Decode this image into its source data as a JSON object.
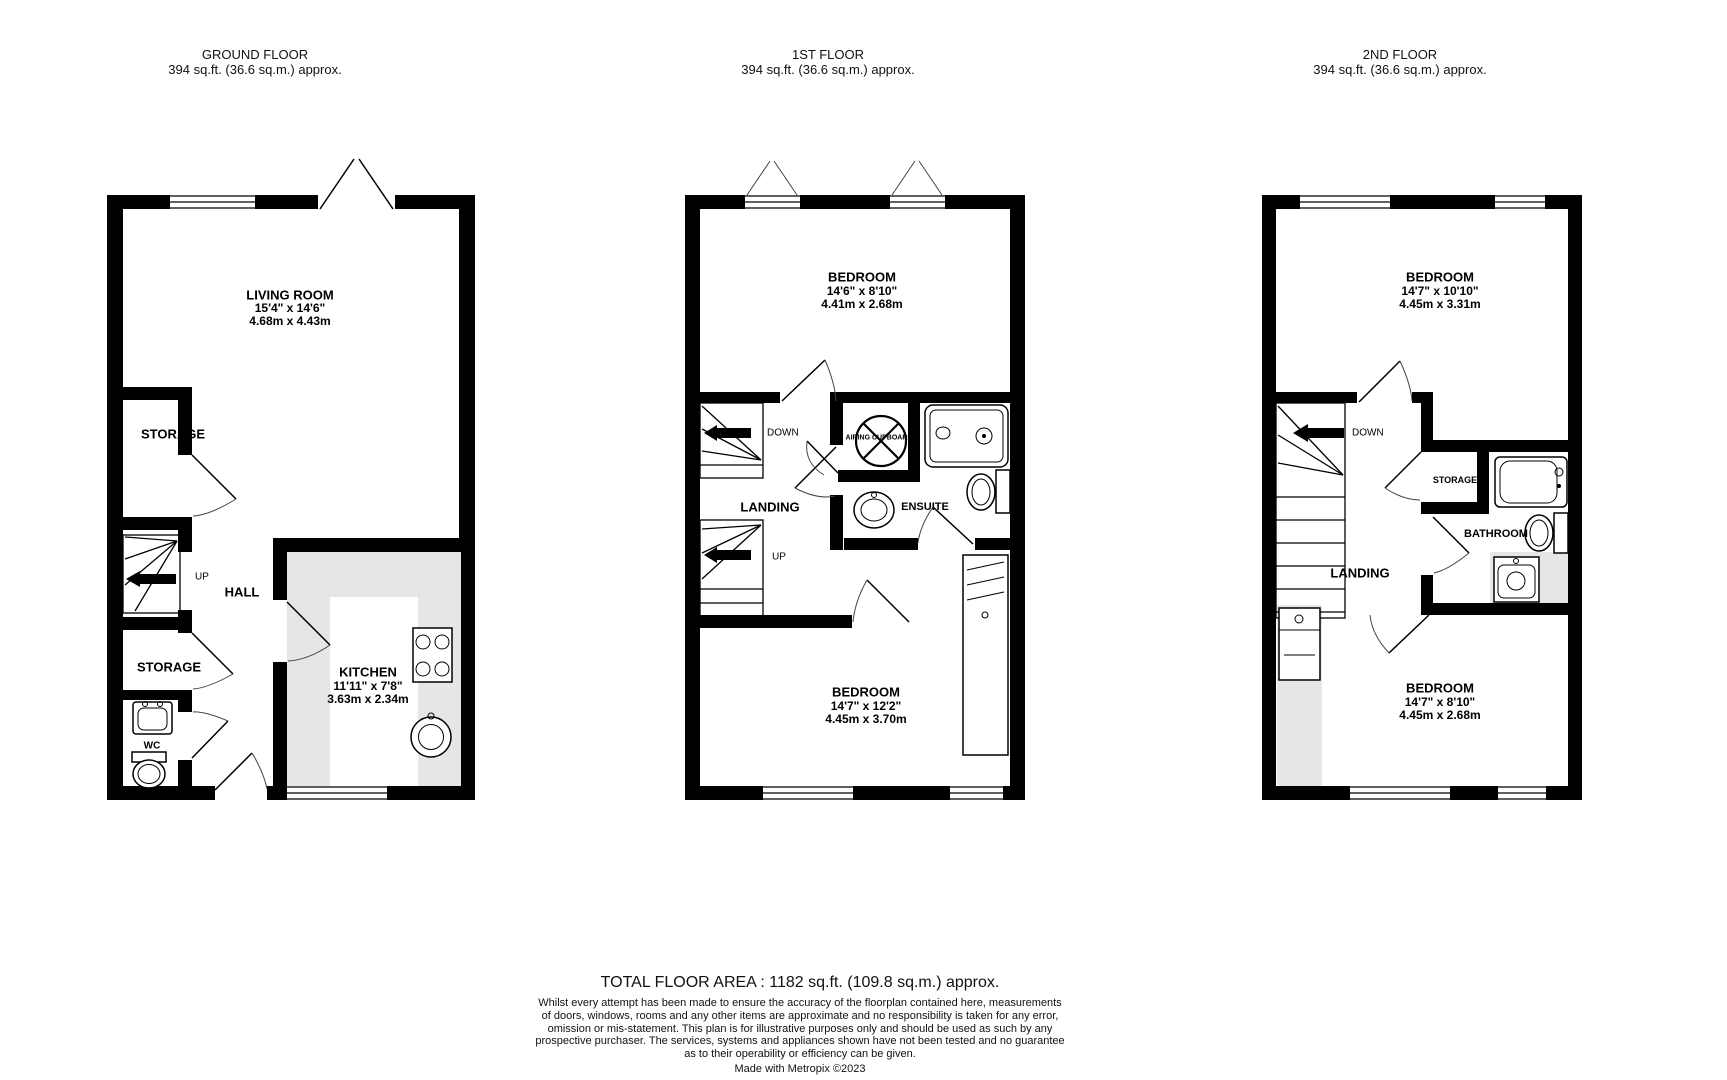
{
  "page": {
    "background": "#ffffff",
    "wall_color": "#000000",
    "counter_color": "#e6e6e6"
  },
  "floors": [
    {
      "title": "GROUND FLOOR",
      "area": "394 sq.ft. (36.6 sq.m.) approx.",
      "labels": {
        "living_room": {
          "name": "LIVING ROOM",
          "imperial": "15'4\"  x 14'6\"",
          "metric": "4.68m  x 4.43m"
        },
        "storage_top": "STORAGE",
        "up": "UP",
        "hall": "HALL",
        "storage_bottom": "STORAGE",
        "wc": "WC",
        "kitchen": {
          "name": "KITCHEN",
          "imperial": "11'11\"  x 7'8\"",
          "metric": "3.63m  x 2.34m"
        }
      }
    },
    {
      "title": "1ST FLOOR",
      "area": "394 sq.ft. (36.6 sq.m.) approx.",
      "labels": {
        "bedroom_top": {
          "name": "BEDROOM",
          "imperial": "14'6\"  x 8'10\"",
          "metric": "4.41m  x 2.68m"
        },
        "down": "DOWN",
        "landing": "LANDING",
        "up": "UP",
        "airing": "AIRING CUPBOARD",
        "ensuite": "ENSUITE",
        "bedroom_bottom": {
          "name": "BEDROOM",
          "imperial": "14'7\"  x 12'2\"",
          "metric": "4.45m  x 3.70m"
        }
      }
    },
    {
      "title": "2ND FLOOR",
      "area": "394 sq.ft. (36.6 sq.m.) approx.",
      "labels": {
        "bedroom_top": {
          "name": "BEDROOM",
          "imperial": "14'7\"  x 10'10\"",
          "metric": "4.45m  x 3.31m"
        },
        "down": "DOWN",
        "storage": "STORAGE",
        "bathroom": "BATHROOM",
        "landing": "LANDING",
        "bedroom_bottom": {
          "name": "BEDROOM",
          "imperial": "14'7\"  x 8'10\"",
          "metric": "4.45m  x 2.68m"
        }
      }
    }
  ],
  "footer": {
    "total": "TOTAL FLOOR AREA : 1182 sq.ft. (109.8 sq.m.) approx.",
    "disclaimer": [
      "Whilst every attempt has been made to ensure the accuracy of the floorplan contained here, measurements",
      "of doors, windows, rooms and any other items are approximate and no responsibility is taken for any error,",
      "omission or mis-statement. This plan is for illustrative purposes only and should be used as such by any",
      "prospective purchaser. The services, systems and appliances shown have not been tested and no guarantee",
      "as to their operability or efficiency can be given."
    ],
    "credit": "Made with Metropix ©2023"
  }
}
